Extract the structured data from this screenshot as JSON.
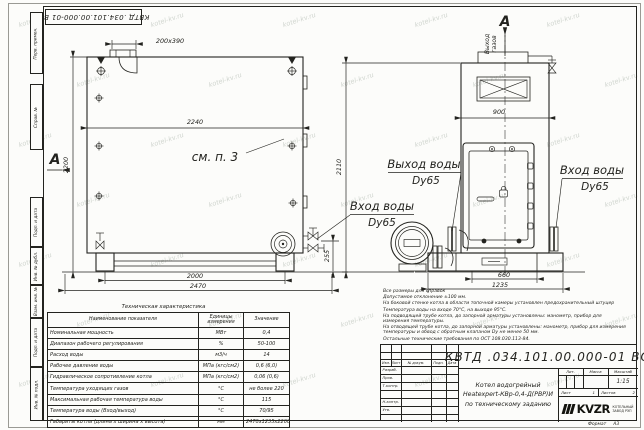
{
  "watermark": "kotel-kv.ru",
  "frame": {
    "stamp_rotated": "КВТД .034.101.00.000-01 ВО",
    "side_columns": [
      "Перв. примен.",
      "Справ. №",
      "Подп. и дата",
      "Инв. № дубл.",
      "Взам. инв. №",
      "Подп. и дата",
      "Инв. № подл."
    ],
    "format_label": "Формат",
    "format_value": "А3"
  },
  "side_view": {
    "dim_hatch": "200x390",
    "dim_body_length": "2240",
    "dim_height": "2200",
    "see_note": "см. п. 3",
    "section_label": "А",
    "dim_supports": "2000",
    "dim_total_length": "2470",
    "dim_nozzle_height": "255"
  },
  "front_view": {
    "section_label": "А",
    "gas_exit_word1": "Выход",
    "gas_exit_word2": "газов",
    "dim_width": "900",
    "dim_height": "2110",
    "dim_base_inner": "660",
    "dim_base_width": "1235"
  },
  "labels": {
    "water_outlet_line1": "Выход воды",
    "water_outlet_line2": "Dy65",
    "water_inlet_mid_line1": "Вход воды",
    "water_inlet_mid_line2": "Dy65",
    "water_inlet_right_line1": "Вход воды",
    "water_inlet_right_line2": "Dy65"
  },
  "spec_table": {
    "title": "Техническая характеристика",
    "headers": [
      "Наименование показателя",
      "Единицы измерения",
      "Значение"
    ],
    "rows": [
      {
        "name": "Номинальная мощность",
        "unit": "МВт",
        "value": "0,4"
      },
      {
        "name": "Диапазон рабочего регулирования",
        "unit": "%",
        "value": "50-100"
      },
      {
        "name": "Расход воды",
        "unit": "м3/ч",
        "value": "14"
      },
      {
        "name": "Рабочее давление воды",
        "unit": "МПа (кгс/см2)",
        "value": "0,6 (6,0)"
      },
      {
        "name": "Гидравлическое сопротивление котла",
        "unit": "МПа (кгс/см2)",
        "value": "0,06 (0,6)"
      },
      {
        "name": "Температура уходящих газов",
        "unit": "°С",
        "value": "не более 220"
      },
      {
        "name": "Максимальная рабочая температура воды",
        "unit": "°С",
        "value": "115"
      },
      {
        "name": "Температура воды (Вход/выход)",
        "unit": "°С",
        "value": "70/95"
      },
      {
        "name": "Габариты котла (длина х ширина х высота)",
        "unit": "мм",
        "value": "2470х1235х2200"
      }
    ]
  },
  "notes": {
    "lines": [
      "Все размеры для справок",
      "Допустимое отклонение ±100 мм.",
      "На боковой стенке котла в области топочной камеры установлен предохранительный штуцер",
      "Температура воды на входе 70°С, на выходе 95°С.",
      "На подводящей трубе котла, до запорной арматуры установлены: манометр, прибор для измерения температуры.",
      "На отводящей трубе котла, до запорной арматуры установлены: манометр, прибор для измерения температуры и обвод с обратным клапаном Dу не менее 50 мм.",
      "Остальные технические требования по ОСТ 108.030.113-84."
    ]
  },
  "title_block": {
    "designation": "КВТД .034.101.00.000-01 ВО",
    "product_lines": [
      "Котел водогрейный",
      "Heatexpert-КВр-0,4-Д(РВР)И",
      "по техническому заданию"
    ],
    "header_cols": [
      "Изм.",
      "Лист",
      "№ докум.",
      "Подп.",
      "Дата"
    ],
    "left_rows": [
      "Разраб.",
      "Пров.",
      "Т.контр.",
      "",
      "Н.контр.",
      "Утв."
    ],
    "lit_label": "Лит.",
    "mass_label": "Масса",
    "scale_label": "Масштаб",
    "scale_value": "1:15",
    "sheet_label": "Лист",
    "sheet_value": "1",
    "sheets_label": "Листов",
    "sheets_value": "2",
    "logo_text": "KVZR",
    "logo_caption": [
      "КОТЕЛЬНЫЙ",
      "ЗАВОД РЭП"
    ]
  }
}
